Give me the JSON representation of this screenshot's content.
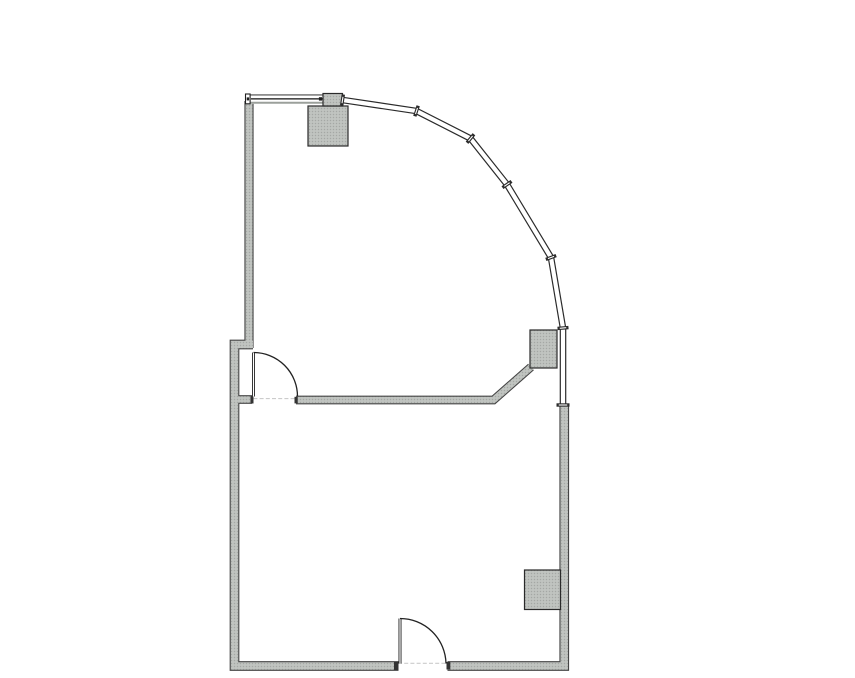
{
  "colors": {
    "background": "#ffffff",
    "wall_edge": "#454545",
    "stipple_base": "#bcbfbc",
    "stipple_dark": "#a4a8a4",
    "stipple_light": "#ced1ce",
    "curtain_edge": "#2b2b2b",
    "glass_white": "#ffffff",
    "threshold": "#cccccc",
    "arc": "#222222",
    "leaf": "#222222",
    "leaf_core": "#ffffff",
    "cap": "#333333",
    "column_edge": "#2a2a2a",
    "window_frame_top": "#4a4a4a",
    "window_glazing": "#111111",
    "window_sill": "#9ba09b",
    "window_tick": "#1f1f1f"
  },
  "floorplan": {
    "canvas": {
      "w": 855,
      "h": 678
    },
    "walls": [
      {
        "name": "wall-left-upper",
        "pts": [
          [
            249,
            101
          ],
          [
            249,
            348
          ]
        ],
        "t": 7
      },
      {
        "name": "wall-left-lower-and-bottom",
        "pts": [
          [
            253,
            344.5
          ],
          [
            234.5,
            344.5
          ],
          [
            234.5,
            666
          ],
          [
            398.5,
            666
          ]
        ],
        "t": 7.5
      },
      {
        "name": "wall-bottom-right-and-right",
        "pts": [
          [
            447.5,
            666
          ],
          [
            564.25,
            666
          ],
          [
            564.25,
            406
          ]
        ],
        "t": 7.5
      },
      {
        "name": "wall-room-divider",
        "pts": [
          [
            296,
            400
          ],
          [
            493.5,
            400
          ],
          [
            531,
            367
          ]
        ],
        "t": 6.5
      },
      {
        "name": "wall-door-jamb-stub",
        "pts": [
          [
            238,
            399.5
          ],
          [
            252,
            399.5
          ]
        ],
        "t": 6.5
      }
    ],
    "window_top": {
      "x": 245.5,
      "y": 94,
      "w": 78,
      "h": 9.8
    },
    "curtain_wall": {
      "points": [
        [
          342.5,
          100
        ],
        [
          416.5,
          111
        ],
        [
          470.5,
          138.5
        ],
        [
          507,
          184.5
        ],
        [
          551,
          257.5
        ],
        [
          563,
          328
        ],
        [
          563,
          405
        ]
      ],
      "outer_w": 6.6,
      "inner_w": 4.2,
      "joints": [
        {
          "x": 342.5,
          "y": 100,
          "a": 98.5,
          "len": 11
        },
        {
          "x": 416.5,
          "y": 111,
          "a": 107.8,
          "len": 11
        },
        {
          "x": 470.5,
          "y": 138.5,
          "a": 129.3,
          "len": 11
        },
        {
          "x": 507,
          "y": 184.5,
          "a": 145.2,
          "len": 11
        },
        {
          "x": 551,
          "y": 257.5,
          "a": 159.6,
          "len": 11
        },
        {
          "x": 563,
          "y": 328,
          "a": 175.2,
          "len": 11
        },
        {
          "x": 563,
          "y": 405,
          "a": 180,
          "len": 13
        }
      ]
    },
    "columns": [
      {
        "name": "column-top",
        "x": 308,
        "y": 106,
        "w": 40,
        "h": 40
      },
      {
        "name": "window-mullion-block",
        "x": 323,
        "y": 93.5,
        "w": 19.5,
        "h": 12.5
      },
      {
        "name": "column-mid-right",
        "x": 530,
        "y": 330,
        "w": 27,
        "h": 38
      },
      {
        "name": "column-bottom-right",
        "x": 524.5,
        "y": 570,
        "w": 36,
        "h": 39.5
      }
    ],
    "doors": [
      {
        "name": "interior-door",
        "leaf": [
          [
            253.5,
            352.5
          ],
          [
            253.5,
            396.5
          ]
        ],
        "arc": {
          "from": [
            253.5,
            352.5
          ],
          "to": [
            297.5,
            396.5
          ],
          "r": 44
        },
        "threshold": [
          [
            241,
            398.6
          ],
          [
            296,
            398.6
          ]
        ],
        "caps": [
          {
            "x": 250.5,
            "y": 396,
            "w": 3,
            "h": 7.5
          },
          {
            "x": 294.5,
            "y": 396.8,
            "w": 3.2,
            "h": 6.6
          }
        ]
      },
      {
        "name": "entry-door",
        "leaf": [
          [
            400,
            618.5
          ],
          [
            400,
            663.5
          ]
        ],
        "arc": {
          "from": [
            400,
            618.5
          ],
          "to": [
            446,
            663.5
          ],
          "r": 46
        },
        "threshold": [
          [
            398,
            663.3
          ],
          [
            447,
            663.3
          ]
        ],
        "caps": [
          {
            "x": 394,
            "y": 662,
            "w": 4.5,
            "h": 8
          },
          {
            "x": 446.5,
            "y": 662,
            "w": 3.8,
            "h": 7.5
          }
        ]
      }
    ]
  }
}
